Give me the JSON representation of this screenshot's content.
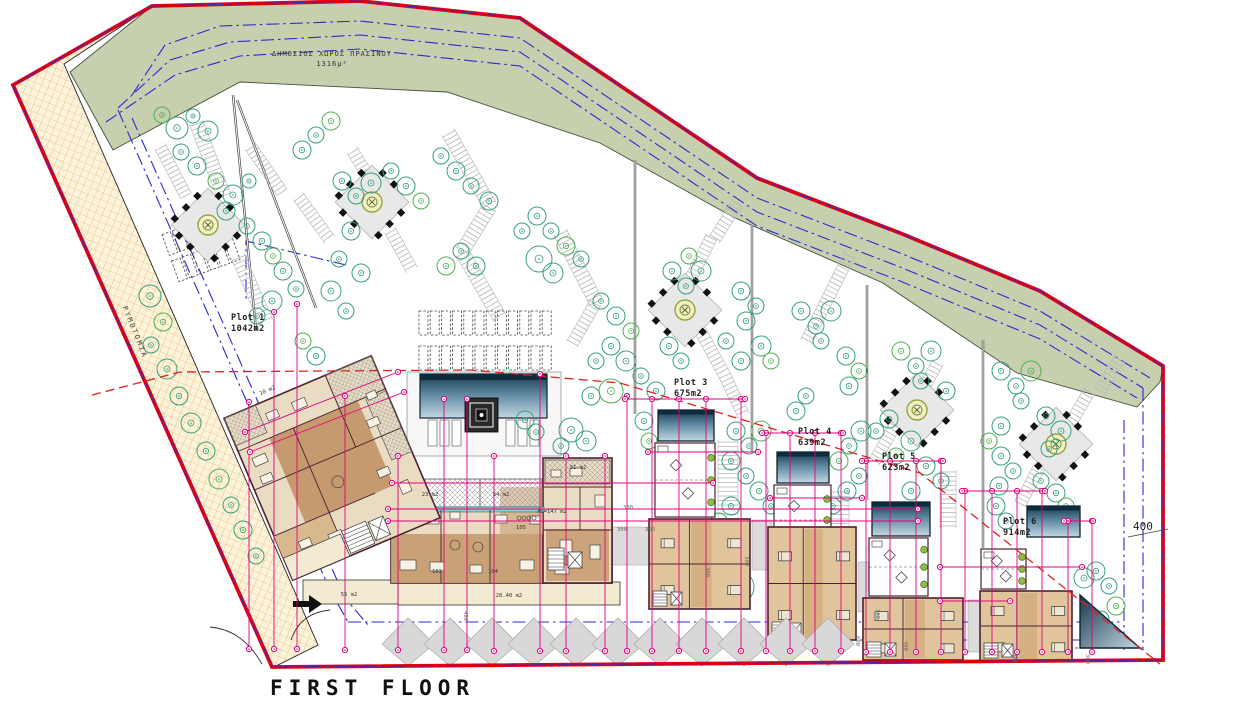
{
  "drawing": {
    "floor_title": "FIRST FLOOR",
    "green_space_label": "ΔΗΜΟΣΙΟΣ ΧΩΡΟΣ ΠΡΑΣΙΝΟΥ",
    "green_space_area": "1316μ²",
    "road_label": "ΡΥΜΟΤΟΜΙΑ",
    "right_dim_label": "400"
  },
  "colors": {
    "boundary_red": "#e10012",
    "boundary_blue_dash": "#2b2bd0",
    "setback_blue": "#2b2bd0",
    "dimension_magenta": "#e5007d",
    "green_space": "#c6cfae",
    "road_fill": "#fcf3da",
    "road_grid": "#d8a85a",
    "building_tan": "#e9dcc2",
    "floor_brown": "#c59a6e",
    "block_tan": "#dfc49c",
    "pool_dark": "#0d2b3c",
    "pool_light": "#bcd3dd",
    "tree_green": "#35a07a",
    "tree_green_alt": "#4fae52",
    "walk_gray": "#bdbdbd",
    "red_dashed": "#e02020",
    "outline_maroon": "#4a2230"
  },
  "plots": [
    {
      "name": "Plot 1",
      "area": "1042m2",
      "x": 231,
      "y": 320
    },
    {
      "name": "Plot 3",
      "area": "675m2",
      "x": 674,
      "y": 385
    },
    {
      "name": "Plot 4",
      "area": "639m2",
      "x": 798,
      "y": 434
    },
    {
      "name": "Plot 5",
      "area": "623m2",
      "x": 882,
      "y": 459
    },
    {
      "name": "Plot 6",
      "area": "914m2",
      "x": 1003,
      "y": 524
    }
  ],
  "room_labels": [
    {
      "t": "23 m2",
      "x": 430,
      "y": 496
    },
    {
      "t": "34 m2",
      "x": 501,
      "y": 496
    },
    {
      "t": "31 m2",
      "x": 578,
      "y": 469
    },
    {
      "t": "A5=147 m2",
      "x": 552,
      "y": 513
    },
    {
      "t": "105",
      "x": 521,
      "y": 529
    },
    {
      "t": "103",
      "x": 437,
      "y": 573
    },
    {
      "t": "104",
      "x": 493,
      "y": 573
    },
    {
      "t": "55 m2",
      "x": 349,
      "y": 596
    },
    {
      "t": "28.40 m2",
      "x": 509,
      "y": 597
    },
    {
      "t": "10 m2",
      "x": 268,
      "y": 392,
      "r": -23
    }
  ],
  "dim_labels": [
    {
      "t": "300",
      "x": 622,
      "y": 531
    },
    {
      "t": "300",
      "x": 650,
      "y": 531
    },
    {
      "t": "300",
      "x": 628,
      "y": 509
    },
    {
      "t": "300",
      "x": 876,
      "y": 614,
      "r": 90
    },
    {
      "t": "600",
      "x": 856,
      "y": 641,
      "r": 90
    },
    {
      "t": "400",
      "x": 904,
      "y": 646,
      "r": 90
    },
    {
      "t": "400",
      "x": 464,
      "y": 616,
      "r": 90
    },
    {
      "t": "300",
      "x": 745,
      "y": 561,
      "r": 90
    },
    {
      "t": "300",
      "x": 706,
      "y": 572,
      "r": 90
    },
    {
      "t": "300",
      "x": 1013,
      "y": 658,
      "r": 90
    },
    {
      "t": "300",
      "x": 1086,
      "y": 659,
      "r": 90
    }
  ],
  "geometry": {
    "trees": [
      [
        162,
        115,
        8
      ],
      [
        177,
        128,
        11
      ],
      [
        193,
        116,
        7
      ],
      [
        208,
        131,
        10
      ],
      [
        181,
        152,
        8
      ],
      [
        197,
        166,
        9
      ],
      [
        216,
        181,
        8
      ],
      [
        233,
        195,
        10
      ],
      [
        249,
        181,
        7
      ],
      [
        226,
        211,
        9
      ],
      [
        247,
        226,
        8
      ],
      [
        262,
        241,
        9
      ],
      [
        273,
        256,
        8
      ],
      [
        283,
        271,
        9
      ],
      [
        296,
        289,
        8
      ],
      [
        272,
        301,
        10
      ],
      [
        257,
        316,
        8
      ],
      [
        150,
        296,
        11
      ],
      [
        163,
        322,
        9
      ],
      [
        151,
        345,
        8
      ],
      [
        167,
        369,
        10
      ],
      [
        179,
        396,
        9
      ],
      [
        191,
        423,
        10
      ],
      [
        206,
        451,
        9
      ],
      [
        219,
        479,
        10
      ],
      [
        231,
        505,
        8
      ],
      [
        243,
        530,
        9
      ],
      [
        256,
        556,
        8
      ],
      [
        302,
        150,
        9
      ],
      [
        316,
        135,
        8
      ],
      [
        331,
        121,
        9
      ],
      [
        342,
        181,
        9
      ],
      [
        356,
        196,
        8
      ],
      [
        371,
        183,
        10
      ],
      [
        391,
        171,
        8
      ],
      [
        406,
        186,
        9
      ],
      [
        421,
        201,
        8
      ],
      [
        351,
        231,
        9
      ],
      [
        339,
        259,
        8
      ],
      [
        361,
        273,
        9
      ],
      [
        331,
        291,
        10
      ],
      [
        346,
        311,
        8
      ],
      [
        303,
        341,
        8
      ],
      [
        316,
        356,
        9
      ],
      [
        441,
        156,
        8
      ],
      [
        456,
        171,
        9
      ],
      [
        471,
        186,
        8
      ],
      [
        489,
        201,
        9
      ],
      [
        446,
        266,
        9
      ],
      [
        461,
        251,
        8
      ],
      [
        476,
        266,
        9
      ],
      [
        522,
        231,
        8
      ],
      [
        537,
        216,
        9
      ],
      [
        551,
        231,
        8
      ],
      [
        566,
        246,
        9
      ],
      [
        581,
        259,
        8
      ],
      [
        539,
        259,
        13
      ],
      [
        553,
        273,
        10
      ],
      [
        601,
        301,
        8
      ],
      [
        616,
        316,
        9
      ],
      [
        631,
        331,
        8
      ],
      [
        611,
        346,
        9
      ],
      [
        596,
        361,
        8
      ],
      [
        626,
        361,
        10
      ],
      [
        641,
        376,
        8
      ],
      [
        656,
        391,
        9
      ],
      [
        611,
        391,
        12
      ],
      [
        591,
        396,
        9
      ],
      [
        571,
        430,
        12
      ],
      [
        586,
        441,
        10
      ],
      [
        561,
        446,
        8
      ],
      [
        644,
        421,
        9
      ],
      [
        649,
        441,
        8
      ],
      [
        525,
        420,
        9
      ],
      [
        536,
        432,
        8
      ],
      [
        672,
        271,
        9
      ],
      [
        686,
        286,
        8
      ],
      [
        701,
        271,
        10
      ],
      [
        689,
        256,
        8
      ],
      [
        741,
        291,
        9
      ],
      [
        756,
        306,
        8
      ],
      [
        746,
        321,
        9
      ],
      [
        726,
        341,
        8
      ],
      [
        761,
        346,
        10
      ],
      [
        771,
        361,
        8
      ],
      [
        741,
        361,
        9
      ],
      [
        681,
        361,
        8
      ],
      [
        669,
        346,
        9
      ],
      [
        736,
        431,
        9
      ],
      [
        749,
        446,
        8
      ],
      [
        761,
        431,
        10
      ],
      [
        731,
        461,
        9
      ],
      [
        746,
        476,
        8
      ],
      [
        759,
        491,
        9
      ],
      [
        771,
        506,
        8
      ],
      [
        731,
        506,
        9
      ],
      [
        719,
        521,
        8
      ],
      [
        801,
        311,
        9
      ],
      [
        816,
        326,
        8
      ],
      [
        831,
        311,
        10
      ],
      [
        821,
        341,
        8
      ],
      [
        846,
        356,
        9
      ],
      [
        859,
        371,
        8
      ],
      [
        849,
        386,
        9
      ],
      [
        806,
        396,
        8
      ],
      [
        796,
        411,
        9
      ],
      [
        861,
        431,
        10
      ],
      [
        849,
        446,
        8
      ],
      [
        839,
        461,
        9
      ],
      [
        859,
        476,
        8
      ],
      [
        847,
        491,
        9
      ],
      [
        833,
        506,
        8
      ],
      [
        876,
        431,
        8
      ],
      [
        889,
        419,
        9
      ],
      [
        901,
        351,
        9
      ],
      [
        916,
        366,
        8
      ],
      [
        931,
        351,
        10
      ],
      [
        921,
        381,
        8
      ],
      [
        946,
        391,
        9
      ],
      [
        911,
        441,
        10
      ],
      [
        896,
        456,
        8
      ],
      [
        926,
        466,
        9
      ],
      [
        941,
        481,
        8
      ],
      [
        911,
        491,
        9
      ],
      [
        1001,
        371,
        9
      ],
      [
        1016,
        386,
        8
      ],
      [
        1031,
        371,
        10
      ],
      [
        1021,
        401,
        8
      ],
      [
        1046,
        416,
        9
      ],
      [
        1061,
        431,
        10
      ],
      [
        1049,
        449,
        8
      ],
      [
        1001,
        426,
        9
      ],
      [
        989,
        441,
        8
      ],
      [
        1001,
        456,
        9
      ],
      [
        1013,
        471,
        8
      ],
      [
        999,
        486,
        9
      ],
      [
        1041,
        481,
        8
      ],
      [
        1056,
        493,
        9
      ],
      [
        1066,
        506,
        8
      ],
      [
        996,
        506,
        9
      ],
      [
        1006,
        521,
        8
      ],
      [
        1084,
        578,
        10
      ],
      [
        1096,
        571,
        9
      ],
      [
        1109,
        586,
        8
      ],
      [
        1116,
        606,
        9
      ],
      [
        1101,
        619,
        8
      ],
      [
        690,
        582,
        16
      ],
      [
        714,
        585,
        16
      ],
      [
        738,
        587,
        16
      ]
    ],
    "vlines": [
      [
        249,
        402,
        649
      ],
      [
        274,
        312,
        649
      ],
      [
        297,
        304,
        649
      ],
      [
        345,
        396,
        650
      ],
      [
        398,
        456,
        650
      ],
      [
        444,
        399,
        650
      ],
      [
        467,
        399,
        650
      ],
      [
        494,
        456,
        651
      ],
      [
        540,
        374,
        651
      ],
      [
        566,
        456,
        651
      ],
      [
        605,
        456,
        651
      ],
      [
        627,
        396,
        651
      ],
      [
        652,
        399,
        651
      ],
      [
        679,
        399,
        651
      ],
      [
        706,
        399,
        651
      ],
      [
        741,
        399,
        651
      ],
      [
        766,
        433,
        651
      ],
      [
        790,
        433,
        651
      ],
      [
        815,
        433,
        651
      ],
      [
        841,
        433,
        651
      ],
      [
        866,
        461,
        652
      ],
      [
        890,
        461,
        652
      ],
      [
        916,
        461,
        652
      ],
      [
        941,
        461,
        652
      ],
      [
        965,
        491,
        652
      ],
      [
        992,
        491,
        652
      ],
      [
        1017,
        491,
        652
      ],
      [
        1042,
        491,
        652
      ],
      [
        1068,
        521,
        652
      ],
      [
        1092,
        521,
        652
      ]
    ],
    "hlines": [
      [
        483,
        392,
        713
      ],
      [
        509,
        388,
        918
      ],
      [
        521,
        388,
        918
      ],
      [
        452,
        648,
        758
      ],
      [
        399,
        625,
        745
      ],
      [
        498,
        770,
        862
      ],
      [
        567,
        940,
        1082
      ],
      [
        601,
        940,
        1010
      ],
      [
        433,
        762,
        843
      ],
      [
        461,
        862,
        943
      ],
      [
        491,
        962,
        1045
      ],
      [
        521,
        1064,
        1093
      ]
    ],
    "diag_dims": [
      [
        245,
        432,
        398,
        372
      ],
      [
        250,
        452,
        404,
        392
      ]
    ],
    "villas": [
      {
        "name": "villa-plot3",
        "pool": [
          658,
          410,
          56,
          31
        ],
        "terrace": [
          655,
          443,
          60,
          74
        ],
        "block": [
          649,
          519,
          101,
          90
        ]
      },
      {
        "name": "villa-plot4",
        "pool": [
          777,
          452,
          52,
          31
        ],
        "terrace": [
          774,
          485,
          57,
          70
        ],
        "block": [
          768,
          527,
          88,
          113
        ]
      },
      {
        "name": "villa-plot5",
        "pool": [
          872,
          502,
          58,
          34
        ],
        "terrace": [
          869,
          538,
          59,
          58
        ],
        "block": [
          863,
          598,
          100,
          62
        ]
      },
      {
        "name": "villa-plot6",
        "pool": [
          1027,
          506,
          53,
          31
        ],
        "terrace": [
          981,
          549,
          45,
          40
        ],
        "block": [
          980,
          591,
          92,
          70
        ]
      }
    ],
    "pergolas": [
      [
        208,
        225
      ],
      [
        372,
        202
      ],
      [
        685,
        310
      ],
      [
        917,
        410
      ],
      [
        1056,
        444
      ]
    ],
    "ladders": [
      [
        196,
        122,
        224,
        196,
        14
      ],
      [
        238,
        256,
        266,
        322,
        14
      ],
      [
        160,
        146,
        186,
        196,
        12
      ],
      [
        352,
        150,
        374,
        186,
        12
      ],
      [
        390,
        230,
        412,
        270,
        12
      ],
      [
        448,
        132,
        490,
        206,
        14
      ],
      [
        490,
        206,
        462,
        252,
        14
      ],
      [
        462,
        252,
        500,
        318,
        14
      ],
      [
        560,
        232,
        596,
        302,
        14
      ],
      [
        596,
        302,
        572,
        344,
        12
      ],
      [
        712,
        236,
        690,
        280,
        12
      ],
      [
        738,
        202,
        714,
        240,
        12
      ],
      [
        700,
        330,
        724,
        374,
        12
      ],
      [
        724,
        374,
        744,
        416,
        12
      ],
      [
        728,
        440,
        728,
        520,
        20
      ],
      [
        828,
        298,
        806,
        342,
        12
      ],
      [
        850,
        254,
        828,
        298,
        12
      ],
      [
        840,
        490,
        840,
        558,
        18
      ],
      [
        938,
        362,
        916,
        402,
        12
      ],
      [
        896,
        424,
        874,
        462,
        12
      ],
      [
        948,
        470,
        948,
        528,
        16
      ],
      [
        1090,
        390,
        1068,
        428,
        12
      ],
      [
        1040,
        466,
        1020,
        504,
        12
      ],
      [
        1120,
        358,
        1098,
        394,
        12
      ],
      [
        250,
        146,
        282,
        192,
        12
      ],
      [
        298,
        196,
        330,
        240,
        12
      ]
    ],
    "dash_rows": [
      {
        "x": 419,
        "y": 311,
        "cols": 12,
        "w": 9,
        "h": 24,
        "gap": 2.2,
        "rot": 0,
        "cx": 0,
        "cy": 0
      },
      {
        "x": 419,
        "y": 346,
        "cols": 12,
        "w": 9,
        "h": 24,
        "gap": 2.2,
        "rot": 0,
        "cx": 0,
        "cy": 0
      },
      {
        "x": 166,
        "y": 222,
        "cols": 6,
        "w": 9,
        "h": 22,
        "gap": 2.2,
        "rot": -20,
        "cx": 200,
        "cy": 240
      },
      {
        "x": 166,
        "y": 250,
        "cols": 6,
        "w": 9,
        "h": 22,
        "gap": 2.2,
        "rot": -20,
        "cx": 200,
        "cy": 240
      }
    ],
    "zigzag": {
      "x0": 408,
      "step": 42,
      "count": 11,
      "cy": 644,
      "rx": 26,
      "top": 618,
      "bottom": 666
    },
    "gray_strips": [
      [
        752,
        520,
        20,
        50
      ],
      [
        858,
        562,
        20,
        50
      ],
      [
        968,
        600,
        20,
        52
      ],
      [
        610,
        527,
        40,
        38
      ]
    ]
  }
}
